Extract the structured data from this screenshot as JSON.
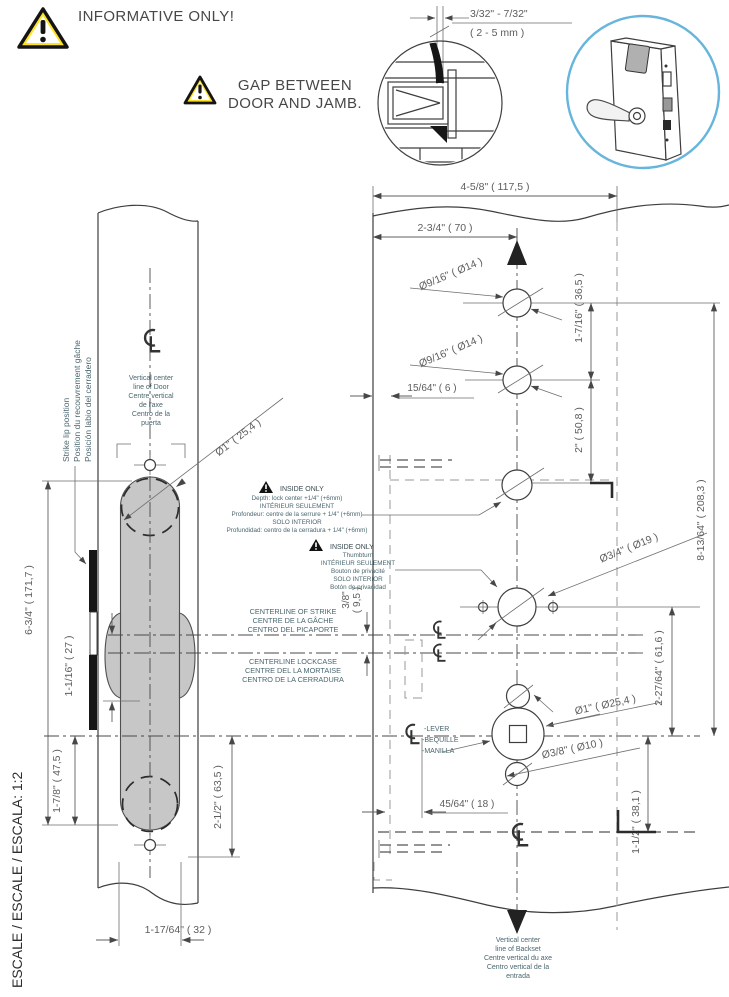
{
  "colors": {
    "accent_blue": "#66b5dc",
    "warning_yellow": "#ffe226",
    "slot_gray": "#c7c7c7",
    "line_dark": "#3e3e3e",
    "annotation_teal": "#49666e"
  },
  "header": {
    "informative": "INFORMATIVE ONLY!",
    "gap_line1": "GAP BETWEEN",
    "gap_line2": "DOOR AND JAMB.",
    "gap_dim_in": "3/32\" - 7/32\"",
    "gap_dim_mm": "( 2 - 5 mm )"
  },
  "scale_caption": "ESCALE / ESCALE / ESCALA: 1:2",
  "edge_view": {
    "centerline_note": [
      "Vertical center",
      "line of Door",
      "Centre vertical",
      "de l'axe",
      "Centro de la",
      "puerta"
    ],
    "strike_note": [
      "Strike lip position",
      "Position du recouvrement gâche",
      "Posición labio del cerradero"
    ],
    "dims": {
      "bore": "Ø1\" ( 25,4 )",
      "height": "6-3/4\" ( 171,7 )",
      "cl_gap": "1-1/16\" ( 27 )",
      "lower_a": "1-7/8\" ( 47,5 )",
      "lower_b": "2-1/2\" ( 63,5 )",
      "pocket_w": "1-17/64\" ( 32 )"
    }
  },
  "face_view": {
    "dims": {
      "total_w": "4-5/8\" ( 117,5 )",
      "backset": "2-3/4\" ( 70 )",
      "top_hole_1": "Ø9/16\" ( Ø14 )",
      "top_hole_2": "Ø9/16\" ( Ø14 )",
      "edge_off": "15/64\" ( 6 )",
      "v_36_5": "1-7/16\" ( 36,5 )",
      "v_50_8": "2\" ( 50,8 )",
      "v_208_3": "8-13/64\" ( 208,3 )",
      "thumb_hole": "Ø3/4\" ( Ø19 )",
      "v_61_6": "2-27/64\" ( 61,6 )",
      "strike_off_a": "3/8\"",
      "strike_off_b": "( 9,5 )",
      "lever_hole": "Ø1\" ( Ø25,4 )",
      "mount_hole": "Ø3/8\" ( Ø10 )",
      "h_18": "45/64\" ( 18 )",
      "v_38_1": "1-1/2\" ( 38,1 )"
    },
    "inside_depth": [
      "INSIDE ONLY",
      "Depth: lock center +1/4\" (+6mm)",
      "INTÉRIEUR SEULEMENT",
      "Profondeur: centre de la serrure + 1/4\" (+6mm)",
      "SOLO INTERIOR",
      "Profundidad: centro de la cerradura + 1/4\" (+6mm)"
    ],
    "inside_thumb": [
      "INSIDE ONLY",
      "Thumbturn",
      "INTÉRIEUR SEULEMENT",
      "Bouton de privacité",
      "SOLO INTERIOR",
      "Botón de privacidad"
    ],
    "cl_strike": [
      "CENTERLINE OF STRIKE",
      "CENTRE DE LA GÂCHE",
      "CENTRO DEL PICAPORTE"
    ],
    "cl_lockcase": [
      "CENTERLINE LOCKCASE",
      "CENTRE DEL LA MORTAISE",
      "CENTRO DE LA CERRADURA"
    ],
    "lever": [
      "-LEVER",
      "-BEQUILLE",
      "-MANILLA"
    ],
    "backset_note": [
      "Vertical center",
      "line of Backset",
      "Centre vertical du axe",
      "Centro vertical de la",
      "entrada"
    ]
  }
}
